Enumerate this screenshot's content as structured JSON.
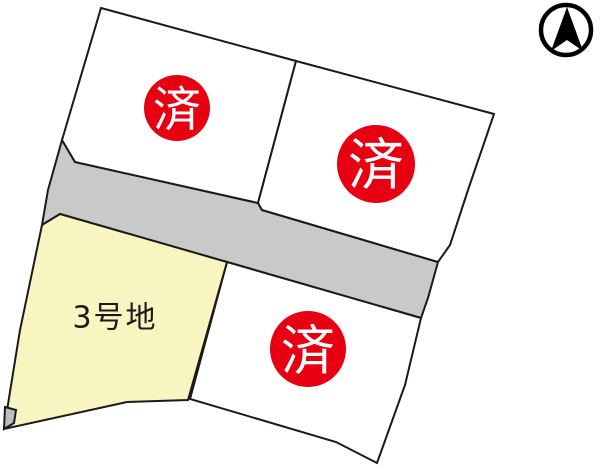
{
  "map_title": "housing-lot-layout-map",
  "colors": {
    "background": "#ffffff",
    "outline": "#1a1a1a",
    "lot_fill": "#ffffff",
    "available_lot_fill": "#f9f5c0",
    "road_fill": "#c9c9c9",
    "setback_fill": "#bdbdbd",
    "sold_badge": "#e60012",
    "sold_badge_text": "#ffffff",
    "label_text": "#1a1a1a",
    "compass": "#000000"
  },
  "lots": [
    {
      "id": "top-left",
      "status": "sold",
      "badge": "済"
    },
    {
      "id": "top-right",
      "status": "sold",
      "badge": "済"
    },
    {
      "id": "lot-3",
      "status": "available",
      "label": "3号地"
    },
    {
      "id": "bottom-right",
      "status": "sold",
      "badge": "済"
    }
  ],
  "road": {
    "kind": "road"
  },
  "compass": {
    "icon": "north-arrow"
  }
}
